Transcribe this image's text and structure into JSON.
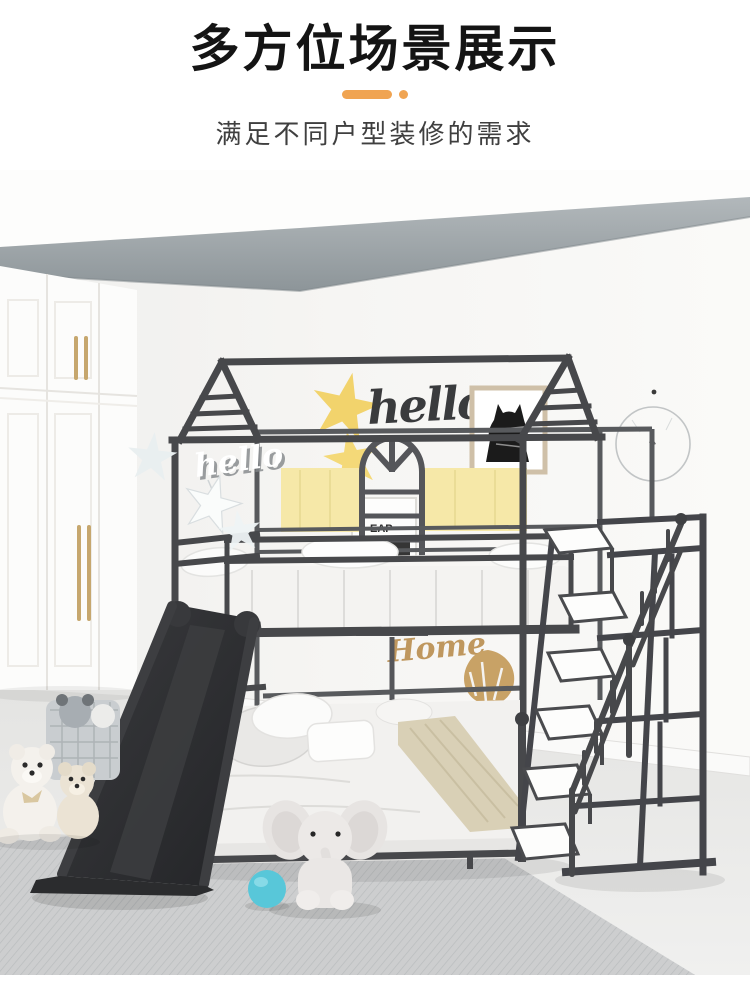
{
  "header": {
    "title": "多方位场景展示",
    "subtitle": "满足不同户型装修的需求",
    "accent_color": "#F0A452"
  },
  "scene": {
    "description": "children bedroom with house-frame bunk bed, slide and stair storage",
    "wall_decor": {
      "hello_sign_black": "hello",
      "hello_sign_white": "hello",
      "home_sign": "Home",
      "poster_text": "EAP"
    },
    "colors": {
      "bed_frame": "#47484B",
      "star_yellow": "#F2D36C",
      "headboard_yellow": "#F6E8A8",
      "decor_gold": "#C39A5E",
      "ball_blue": "#58C7D9",
      "beam_gray": "#9AA2A6",
      "rug_gray": "#C6C8C9",
      "handle_gold": "#C6A76E"
    }
  }
}
